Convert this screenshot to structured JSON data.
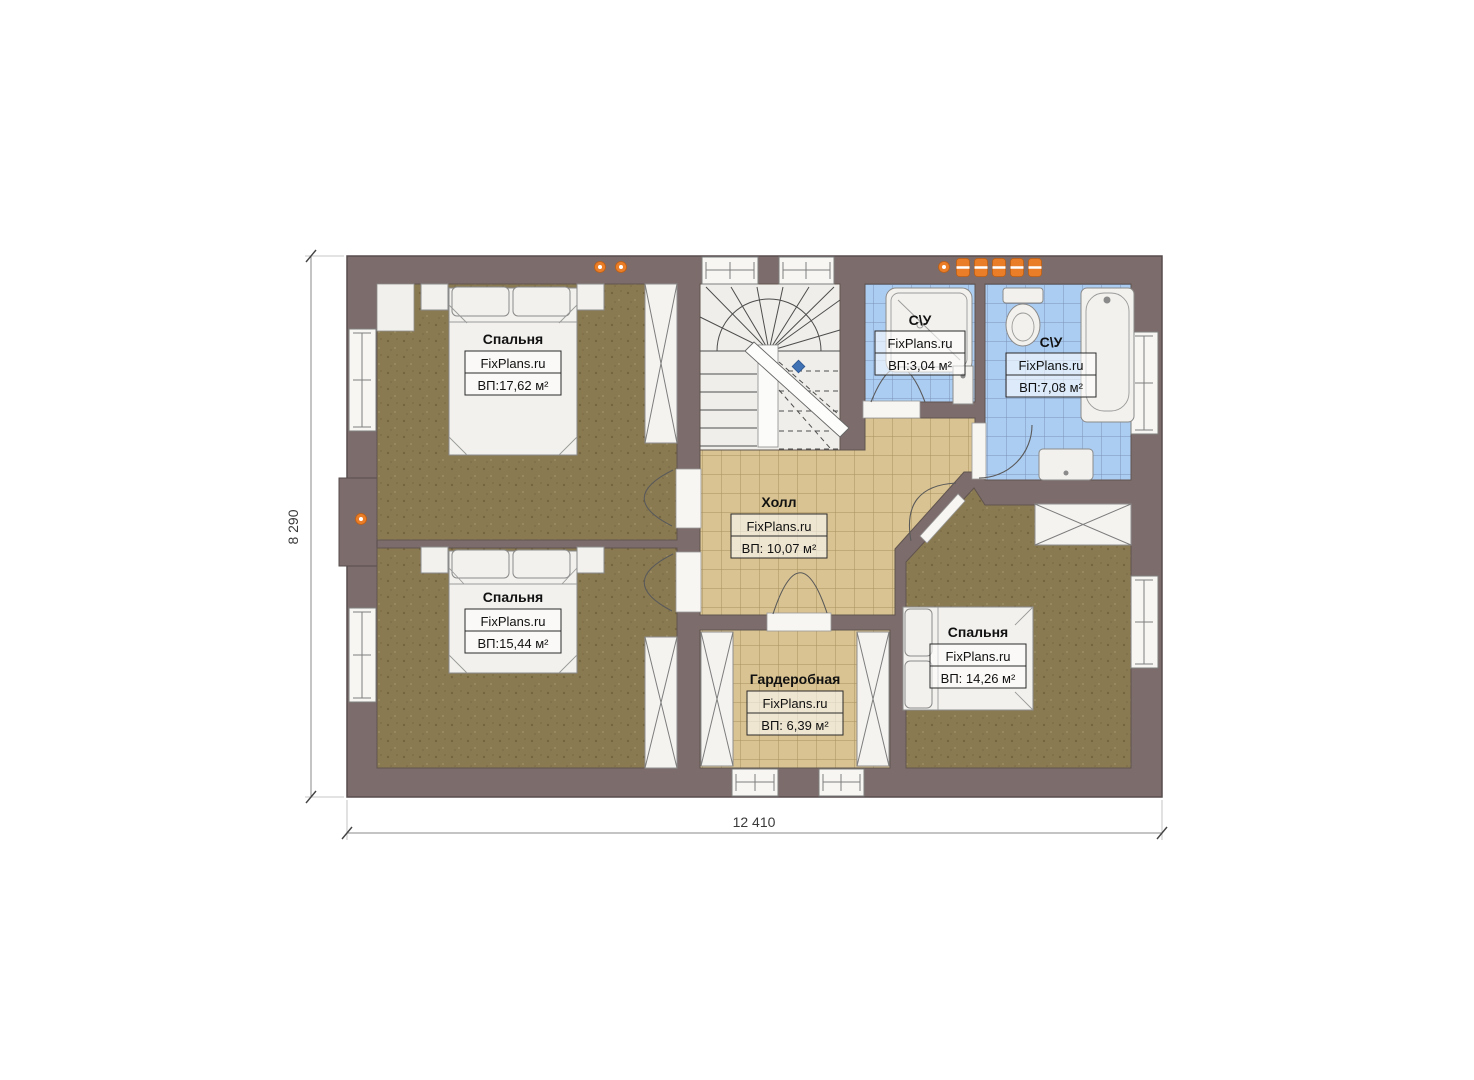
{
  "watermark": "FixPlans.ru",
  "dimensions": {
    "horizontal": "12 410",
    "vertical": "8 290"
  },
  "rooms": {
    "bedroom_top_left": {
      "name": "Спальня",
      "area": "ВП:17,62 м²"
    },
    "bedroom_bottom_left": {
      "name": "Спальня",
      "area": "ВП:15,44 м²"
    },
    "hall": {
      "name": "Холл",
      "area": "ВП: 10,07 м²"
    },
    "wardrobe": {
      "name": "Гардеробная",
      "area": "ВП: 6,39 м²"
    },
    "bedroom_right": {
      "name": "Спальня",
      "area": "ВП: 14,26 м²"
    },
    "bathroom_small": {
      "name": "С\\У",
      "area": "ВП:3,04 м²"
    },
    "bathroom_large": {
      "name": "С\\У",
      "area": "ВП:7,08 м²"
    }
  },
  "colors": {
    "wall": "#7d6c6c",
    "bedroom_floor": "#8a7a52",
    "tile_floor": "#d9c392",
    "bath_floor": "#accdf2",
    "accent_orange": "#ea7e28"
  }
}
